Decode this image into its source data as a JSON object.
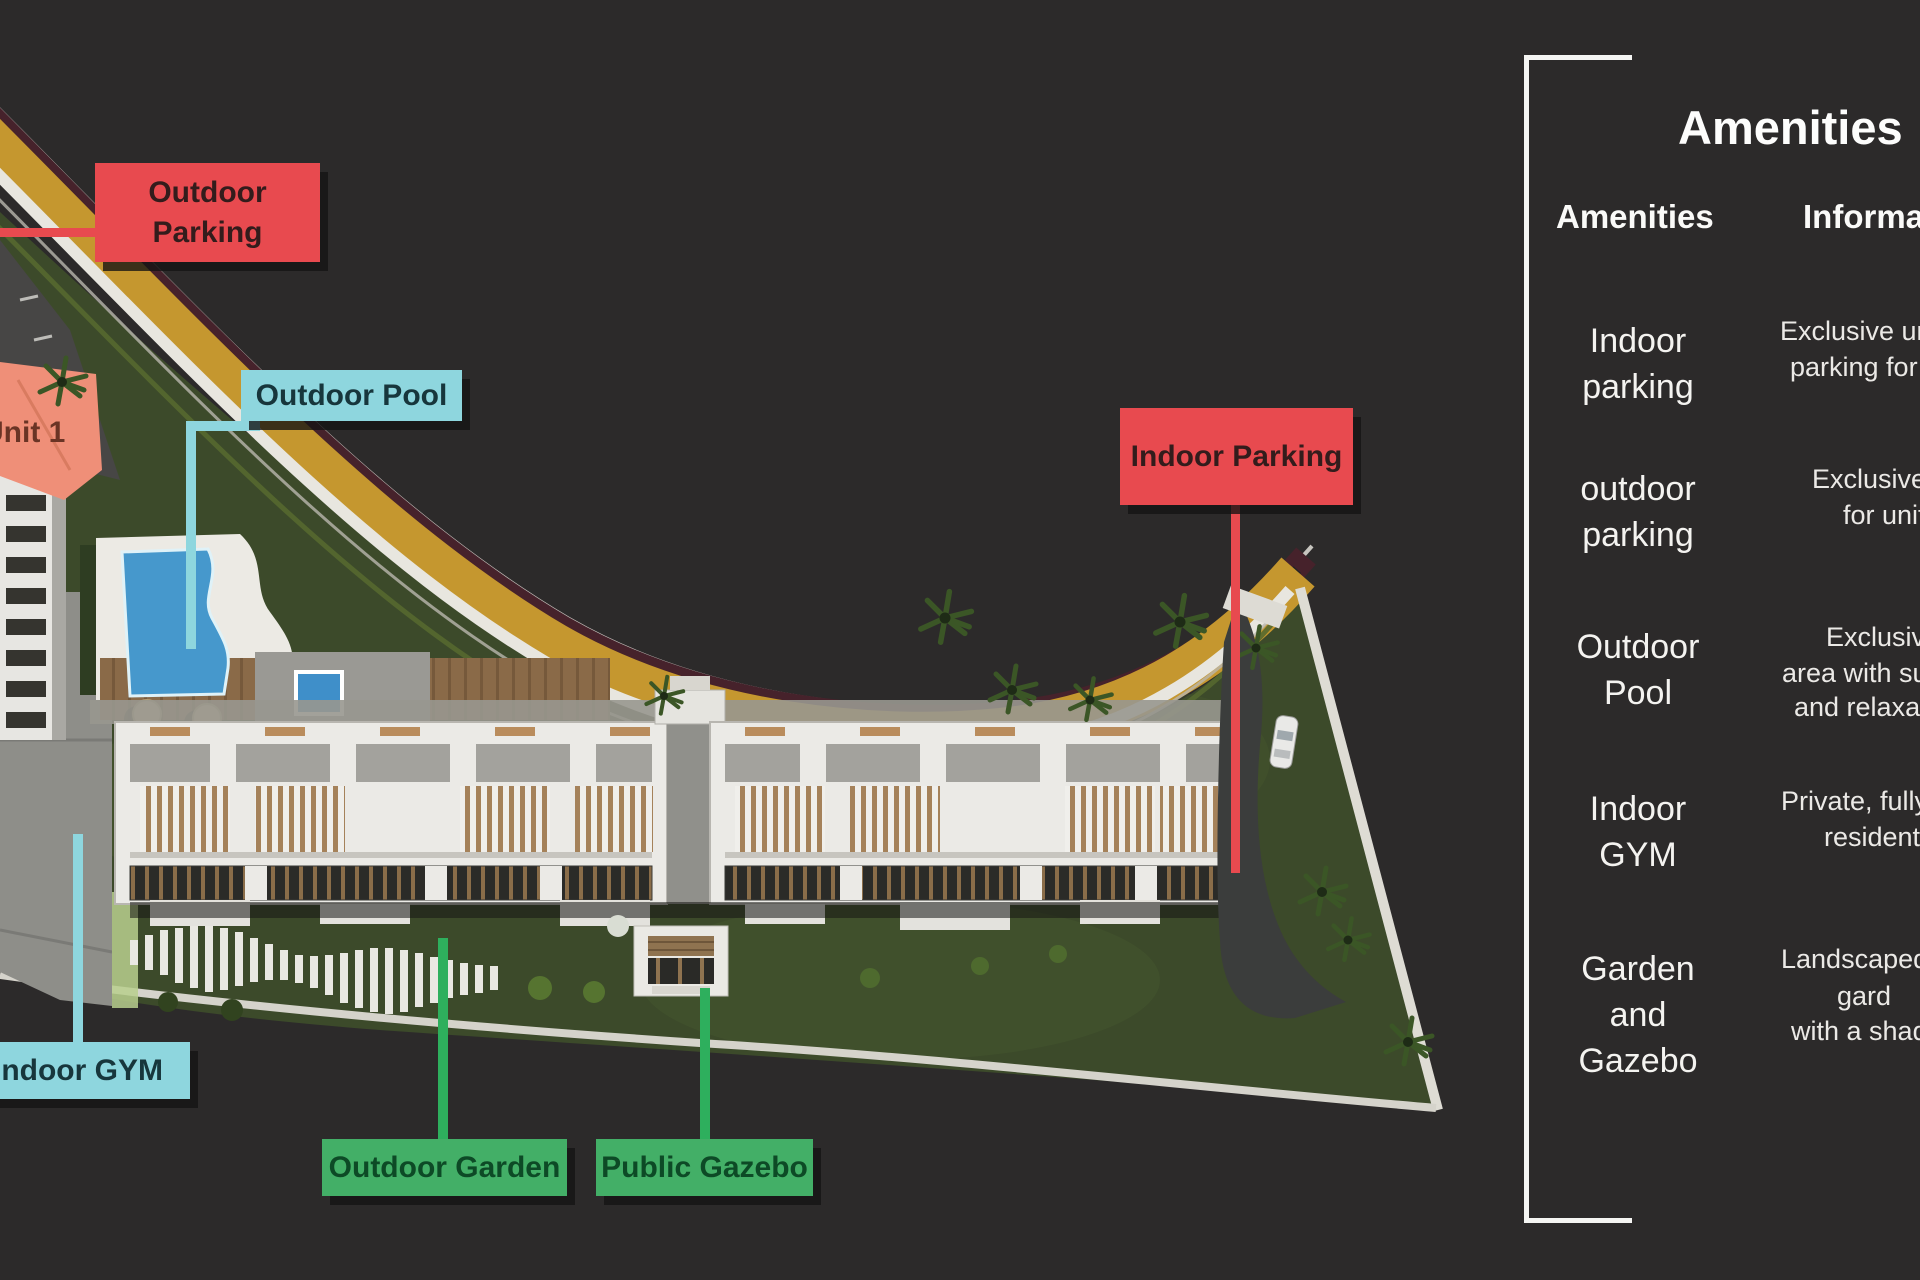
{
  "colors": {
    "background": "#2c2a2a",
    "label_red": "#e84a4f",
    "label_cyan": "#8ed6de",
    "label_green": "#43af67",
    "road_gold": "#c5972f",
    "road_maroon": "#46222b",
    "grass_green": "#3c4a2a",
    "pool_blue": "#4698cc",
    "panel_border": "#f5f5f3",
    "panel_text": "#f4f3f0"
  },
  "site_labels": {
    "outdoor_parking": {
      "lines": [
        "Outdoor",
        "Parking"
      ]
    },
    "outdoor_pool": {
      "text": "Outdoor Pool"
    },
    "indoor_parking": {
      "text": "Indoor Parking"
    },
    "indoor_gym": {
      "text": "Indoor GYM"
    },
    "outdoor_garden": {
      "text": "Outdoor Garden"
    },
    "public_gazebo": {
      "text": "Public Gazebo"
    },
    "unit_tag": {
      "text": "Unit 1"
    }
  },
  "panel": {
    "title": "Amenities",
    "headers": {
      "amenities": "Amenities",
      "information": "Information"
    },
    "rows": [
      {
        "name_lines": [
          "Indoor",
          "parking"
        ],
        "info_lines": [
          "Exclusive un",
          "parking for 1"
        ]
      },
      {
        "name_lines": [
          "outdoor",
          "parking"
        ],
        "info_lines": [
          "Exclusive",
          "for unit"
        ]
      },
      {
        "name_lines": [
          "Outdoor",
          "Pool"
        ],
        "info_lines": [
          "Exclusive",
          "area with su",
          "and relaxat"
        ]
      },
      {
        "name_lines": [
          "Indoor",
          "GYM"
        ],
        "info_lines": [
          "Private, fully",
          "resident"
        ]
      },
      {
        "name_lines": [
          "Garden",
          "and Gazebo"
        ],
        "info_lines": [
          "Landscaped",
          "gard",
          "with a shad"
        ]
      }
    ]
  }
}
